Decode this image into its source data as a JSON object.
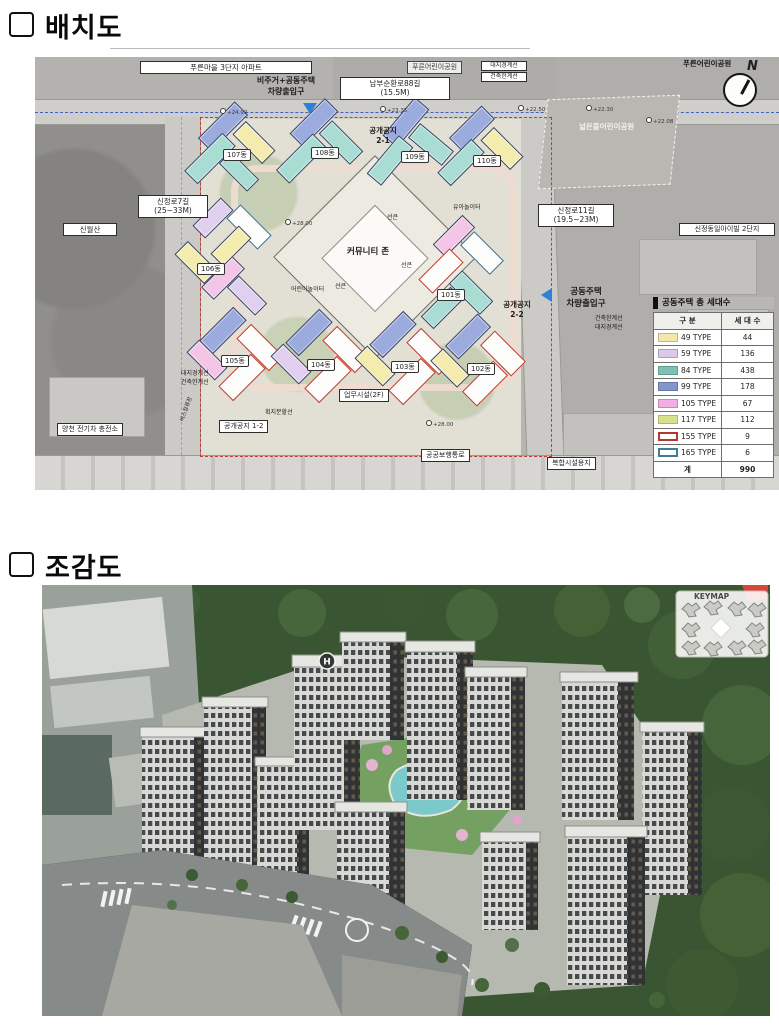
{
  "titles": {
    "section1": "배치도",
    "section2": "조감도"
  },
  "site_plan": {
    "labels": {
      "complex3": "푸른마을 3단지 아파트",
      "road_s88_1": "남부순환로88길",
      "road_s88_2": "(15.5M)",
      "road_s7_1": "신정로7길",
      "road_s7_2": "(25~33M)",
      "mountain": "신월산",
      "road_s11_1": "신정로11길",
      "road_s11_2": "(19.5~23M)",
      "ivill": "신정동일아이빌 2단지",
      "ev": "양천 전기차 충전소",
      "open12": "공개공지 1-2",
      "walkway": "공공보행통로",
      "complex_site": "복합시설용지",
      "office": "업무시설(2F)",
      "boundary_site": "대지경계선",
      "boundary_build": "건축한계선",
      "entry_mixed_1": "비주거+공동주택",
      "entry_mixed_2": "차량출입구",
      "entry_apt_1": "공동주택",
      "entry_apt_2": "차량출입구",
      "park_blue": "푸른어린이공원",
      "park_wide": "넓은뜰어린이공원",
      "open21_1": "공개공지",
      "open21_2": "2-1",
      "open22_1": "공개공지",
      "open22_2": "2-2",
      "community": "커뮤니티 존",
      "sunken": "선큰",
      "kids_play": "어린이놀이터",
      "toddler_play": "유아놀이터",
      "lot_line": "획지분할선",
      "bus_stop": "버스정류장"
    },
    "elevations": [
      "+24.92",
      "+23.35",
      "+22.50",
      "+22.30",
      "+22.08",
      "+28.00",
      "+28.00"
    ],
    "buildings": [
      "107동",
      "108동",
      "109동",
      "110동",
      "106동",
      "101동",
      "105동",
      "104동",
      "103동",
      "102동"
    ],
    "compass_n": "N",
    "legend": {
      "title": "공동주택 총 세대수",
      "col1": "구 분",
      "col2": "세 대 수",
      "rows": [
        {
          "type": "49 TYPE",
          "count": "44",
          "fill": "#f5e7a9",
          "border": "#c2b787"
        },
        {
          "type": "59 TYPE",
          "count": "136",
          "fill": "#dcc9ea",
          "border": "#ab9cc0"
        },
        {
          "type": "84 TYPE",
          "count": "438",
          "fill": "#7fc0b4",
          "border": "#5f9e93"
        },
        {
          "type": "99 TYPE",
          "count": "178",
          "fill": "#8496c9",
          "border": "#6578ab"
        },
        {
          "type": "105 TYPE",
          "count": "67",
          "fill": "#f2aee2",
          "border": "#c887ba"
        },
        {
          "type": "117 TYPE",
          "count": "112",
          "fill": "#d7e28b",
          "border": "#adb968"
        },
        {
          "type": "155 TYPE",
          "count": "9",
          "fill": "#ffffff",
          "border": "#b23a31"
        },
        {
          "type": "165 TYPE",
          "count": "6",
          "fill": "#ffffff",
          "border": "#3e7f95"
        }
      ],
      "total_label": "계",
      "total_value": "990"
    }
  },
  "birdseye": {
    "keymap_title": "KEYMAP",
    "helipad_letter": "H"
  }
}
